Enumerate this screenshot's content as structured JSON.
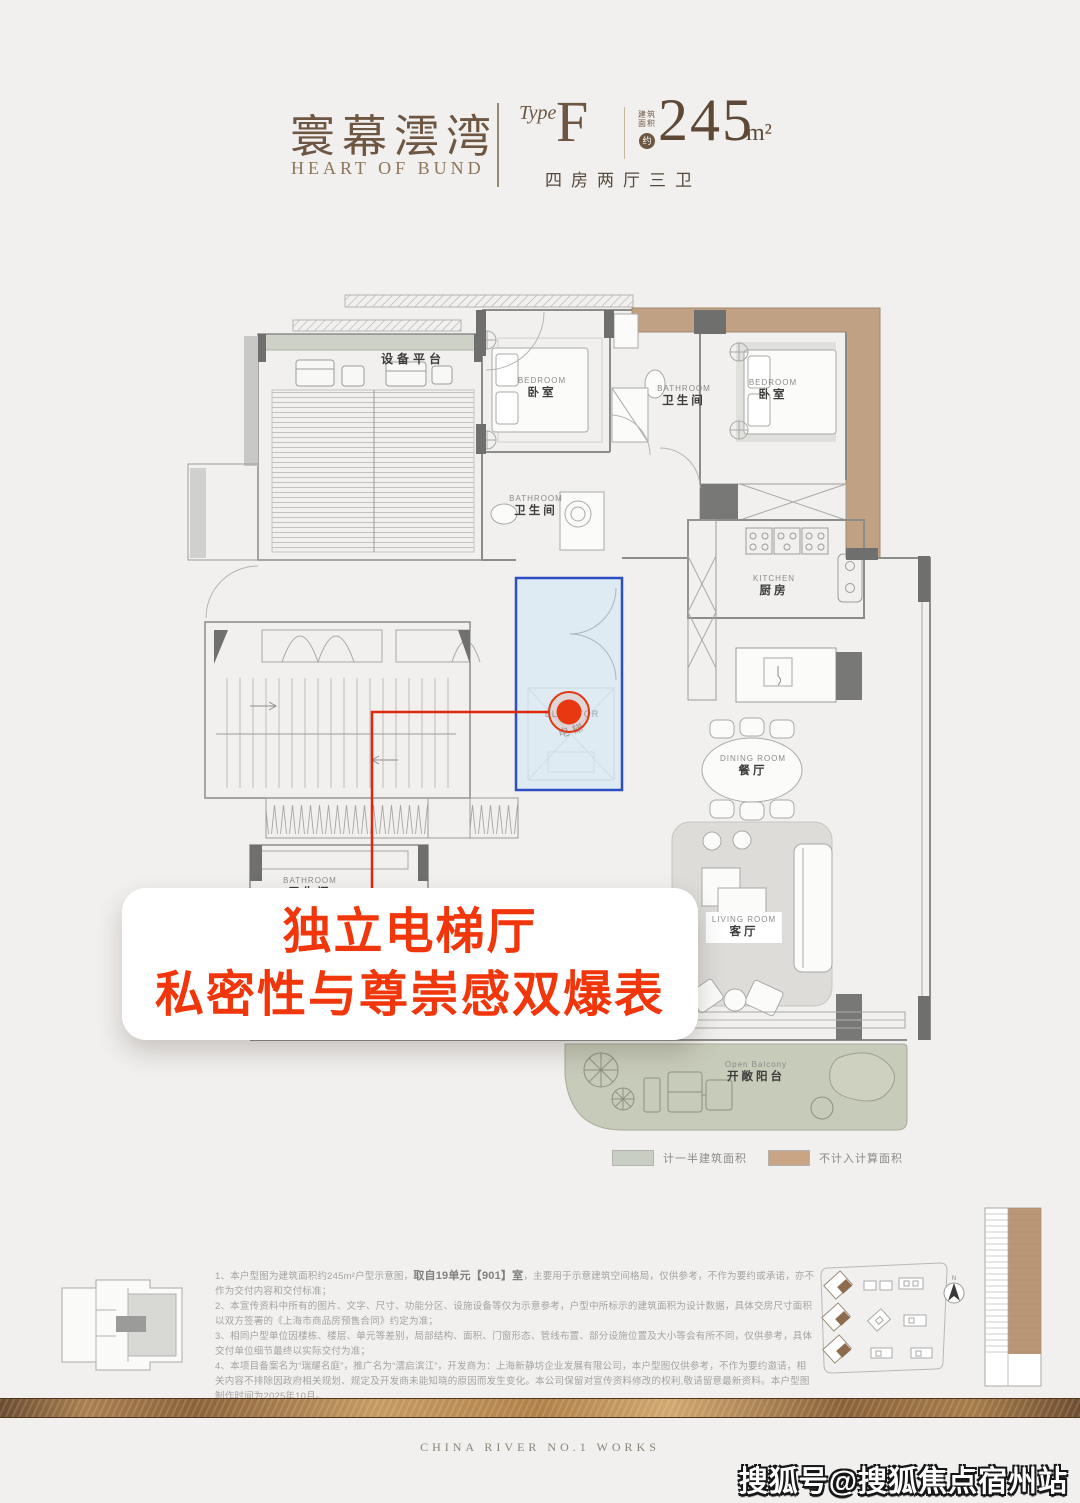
{
  "header": {
    "brand_cn": "寰幕澐湾",
    "brand_en": "HEART OF BUND",
    "type_label": "Type",
    "type_value": "F",
    "area_label_1": "建筑",
    "area_label_2": "面积",
    "area_approx": "约",
    "area_value": "245",
    "area_unit": "m²",
    "subtitle": "四房两厅三卫"
  },
  "plan": {
    "equipment_platform": "设备平台",
    "elevator_en": "ELEVATOR",
    "elevator_cn": "电梯",
    "rooms": [
      {
        "id": "bedroom-top-left",
        "en": "BEDROOM",
        "cn": "卧室"
      },
      {
        "id": "bathroom-top",
        "en": "BATHROOM",
        "cn": "卫生间"
      },
      {
        "id": "bedroom-top-right",
        "en": "BEDROOM",
        "cn": "卧室"
      },
      {
        "id": "bathroom-middle",
        "en": "BATHROOM",
        "cn": "卫生间"
      },
      {
        "id": "kitchen",
        "en": "KITCHEN",
        "cn": "厨房"
      },
      {
        "id": "dining-room",
        "en": "DINING ROOM",
        "cn": "餐厅"
      },
      {
        "id": "living-room",
        "en": "LIVING ROOM",
        "cn": "客厅"
      },
      {
        "id": "open-balcony",
        "en": "Open Balcony",
        "cn": "开敞阳台"
      },
      {
        "id": "bathroom-bottom",
        "en": "BATHROOM",
        "cn": "卫生间"
      }
    ]
  },
  "highlight": {
    "box_color": "#2d4fc4",
    "marker_color": "#e8380f"
  },
  "callout": {
    "line1": "独立电梯厅",
    "line2": "私密性与尊崇感双爆表",
    "color": "#f2360b"
  },
  "legend": [
    {
      "label": "计一半建筑面积",
      "color": "#c9cec3"
    },
    {
      "label": "不计入计算面积",
      "color": "#c9a585"
    }
  ],
  "disclaimer": {
    "line1_pre": "1、本户型图为建筑面积约245m²户型示意图，",
    "line1_bold": "取自19单元【901】室",
    "line1_post": "，主要用于示意建筑空间格局，仅供参考，不作为要约或承诺，亦不作为交付内容和交付标准；",
    "line2": "2、本宣传资料中所有的图片、文字、尺寸、功能分区、设施设备等仅为示意参考，户型中所标示的建筑面积为设计数据，具体交房尺寸面积以双方签署的《上海市商品房预售合同》约定为准；",
    "line3": "3、相同户型单位因楼栋、楼层、单元等差别，局部结构、面积、门窗形态、管线布置、部分设施位置及大小等会有所不同，仅供参考，具体交付单位细节最终以实际交付为准；",
    "line4": "4、本项目备案名为“瑞耀名庭”，推广名为“澐启滨江”，开发商为：上海新静坊企业发展有限公司，本户型图仅供参考，不作为要约邀请，相关内容不排除因政府相关规划、规定及开发商未能知晓的原因而发生变化。本公司保留对宣传资料修改的权利,敬请留意最新资料。本户型图制作时间为2025年10月。"
  },
  "site": {
    "compass_n": "N"
  },
  "footer": {
    "works": "CHINA RIVER NO.1 WORKS"
  },
  "watermark": "搜狐号@搜狐焦点宿州站"
}
